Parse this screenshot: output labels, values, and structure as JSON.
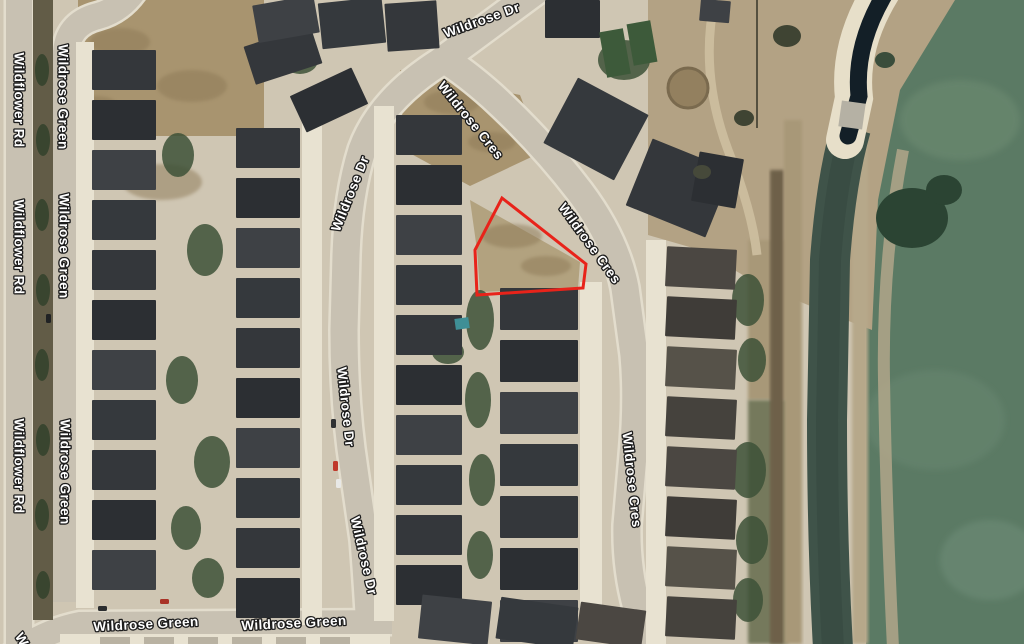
{
  "map": {
    "view": "satellite-aerial",
    "streets": [
      "Wildrose Dr",
      "Wildrose Cres",
      "Wildflower Rd",
      "Wildrose Green"
    ],
    "labels": [
      {
        "text": "Wildrose Dr",
        "x": 482,
        "y": 21,
        "rotation": -20
      },
      {
        "text": "Wildrose Cres",
        "x": 470,
        "y": 121,
        "rotation": 51
      },
      {
        "text": "Wildrose Cres",
        "x": 589,
        "y": 244,
        "rotation": 54
      },
      {
        "text": "Wildrose Cres",
        "x": 631,
        "y": 480,
        "rotation": 84
      },
      {
        "text": "Wildrose Dr",
        "x": 351,
        "y": 194,
        "rotation": -68
      },
      {
        "text": "Wildrose Dr",
        "x": 345,
        "y": 407,
        "rotation": 84
      },
      {
        "text": "Wildrose Dr",
        "x": 363,
        "y": 556,
        "rotation": 77
      },
      {
        "text": "Wildflower Rd",
        "x": 18,
        "y": 100,
        "rotation": 90
      },
      {
        "text": "Wildrose Green",
        "x": 62,
        "y": 97,
        "rotation": 90
      },
      {
        "text": "Wildflower Rd",
        "x": 18,
        "y": 247,
        "rotation": 90
      },
      {
        "text": "Wildrose Green",
        "x": 63,
        "y": 246,
        "rotation": 90
      },
      {
        "text": "Wildflower Rd",
        "x": 18,
        "y": 466,
        "rotation": 90
      },
      {
        "text": "Wildrose Green",
        "x": 64,
        "y": 472,
        "rotation": 90
      },
      {
        "text": "Wildrose Green",
        "x": 146,
        "y": 625,
        "rotation": -3
      },
      {
        "text": "Wildrose Green",
        "x": 294,
        "y": 624,
        "rotation": -3
      },
      {
        "text": "W",
        "x": 21,
        "y": 640,
        "rotation": 60
      }
    ],
    "highlight": {
      "name": "subject-property-outline",
      "points": "502,198 586,264 583,288 477,295 475,250",
      "color": "#e8231a",
      "stroke_width": 3
    },
    "palette": {
      "ground": "#cfc6b3",
      "road": "#c8c1b2",
      "curb": "#e3ddcd",
      "driveway": "#e8e2d1",
      "dirt": "#a8946f",
      "park_green": "#5b7a64",
      "water_channel": "#3f5349",
      "pond": "#131f27",
      "label_fill": "#ffffff",
      "label_stroke": "#1c1c1c"
    }
  }
}
